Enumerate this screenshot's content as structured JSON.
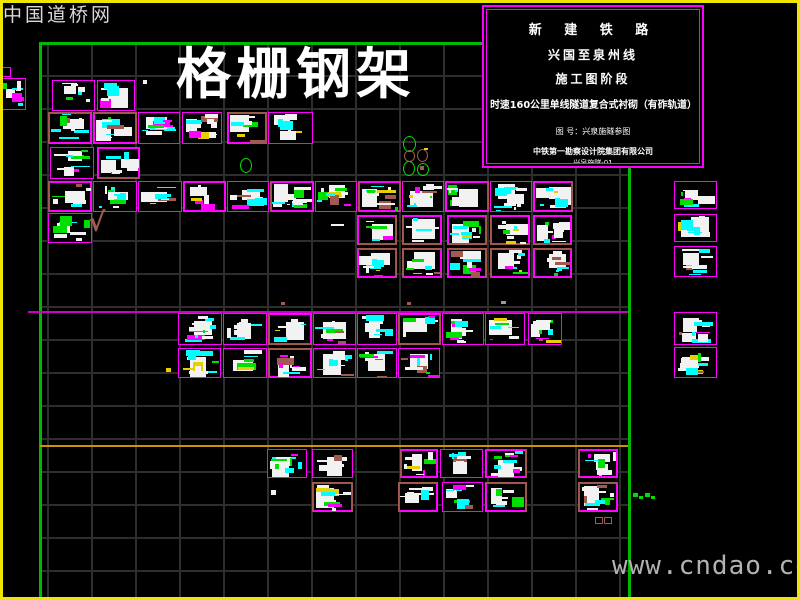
{
  "watermarks": {
    "top_left": "中国道桥网",
    "bottom_right": "www.cndao.com"
  },
  "sheet_title": "格栅钢架",
  "title_block": {
    "line1": "新 建 铁 路",
    "line2": "兴国至泉州线",
    "line3": "施工图阶段",
    "line4": "时速160公里单线隧道复合式衬砌（有砟轨道）",
    "line5": "图 号：兴泉施隧参图",
    "line6": "中铁第一勘察设计院集团有限公司",
    "line7": "兴泉施隧-01",
    "line8": "二〇一九年十月 制"
  },
  "colors": {
    "white": "#f2f2f2",
    "cyan": "#00ffff",
    "green": "#00e000",
    "magenta": "#ff00ff",
    "brown": "#a05a50",
    "yellow": "#e8d000",
    "red": "#ff2020",
    "gray": "#9a9a9a",
    "frame_green": "#00b800",
    "grid_gray": "#2e2e2e",
    "edge_yellow": "#efe600",
    "ref_magenta": "#cc00cc",
    "ref_yellow": "#c89600"
  },
  "drawing": {
    "frame": {
      "top_y": 42,
      "left_x": 39,
      "right_x": 628,
      "bottom_y": 598,
      "thickness": 3
    },
    "grid": {
      "x": 40,
      "y": 44,
      "w": 588,
      "h": 554,
      "cell_w": 44,
      "cell_h": 33,
      "off_x": 7,
      "off_y": 31
    },
    "ref_lines": [
      {
        "x": 28,
        "y": 311,
        "len": 600,
        "h": 2,
        "c": "ref_magenta"
      },
      {
        "x": 40,
        "y": 445,
        "len": 588,
        "h": 2,
        "c": "ref_yellow"
      }
    ],
    "cells": [
      [
        52,
        80,
        43,
        31,
        "m"
      ],
      [
        97,
        80,
        38,
        31,
        "m"
      ],
      [
        0,
        78,
        26,
        32,
        "m"
      ],
      [
        48,
        112,
        44,
        32,
        "b"
      ],
      [
        93,
        112,
        44,
        32,
        "b"
      ],
      [
        138,
        112,
        42,
        32,
        "m"
      ],
      [
        182,
        112,
        40,
        32,
        "m"
      ],
      [
        227,
        112,
        40,
        32,
        "b"
      ],
      [
        268,
        112,
        45,
        32,
        "m"
      ],
      [
        50,
        147,
        44,
        32,
        "m"
      ],
      [
        97,
        147,
        43,
        32,
        "b"
      ],
      [
        48,
        181,
        44,
        31,
        "b"
      ],
      [
        93,
        181,
        44,
        31,
        "m"
      ],
      [
        138,
        181,
        44,
        31,
        "m"
      ],
      [
        183,
        181,
        43,
        31,
        "b"
      ],
      [
        227,
        181,
        42,
        31,
        "m"
      ],
      [
        270,
        181,
        44,
        31,
        "b"
      ],
      [
        315,
        181,
        42,
        31,
        "m"
      ],
      [
        358,
        181,
        43,
        31,
        "b"
      ],
      [
        402,
        181,
        42,
        31,
        "m"
      ],
      [
        445,
        181,
        44,
        31,
        "b"
      ],
      [
        490,
        181,
        42,
        31,
        "m"
      ],
      [
        533,
        181,
        40,
        31,
        "b"
      ],
      [
        48,
        213,
        44,
        30,
        "m"
      ],
      [
        357,
        215,
        40,
        30,
        "b"
      ],
      [
        402,
        215,
        40,
        30,
        "b"
      ],
      [
        447,
        215,
        40,
        30,
        "b"
      ],
      [
        490,
        215,
        40,
        30,
        "b"
      ],
      [
        533,
        215,
        39,
        30,
        "b"
      ],
      [
        357,
        248,
        40,
        30,
        "b"
      ],
      [
        402,
        248,
        40,
        30,
        "b"
      ],
      [
        447,
        248,
        40,
        30,
        "b"
      ],
      [
        490,
        248,
        40,
        30,
        "b"
      ],
      [
        533,
        248,
        39,
        30,
        "b"
      ],
      [
        674,
        181,
        43,
        28,
        "m"
      ],
      [
        674,
        214,
        43,
        28,
        "m"
      ],
      [
        674,
        246,
        43,
        31,
        "m"
      ],
      [
        674,
        312,
        43,
        33,
        "m"
      ],
      [
        674,
        347,
        43,
        31,
        "m"
      ],
      [
        178,
        313,
        44,
        32,
        "m"
      ],
      [
        223,
        313,
        44,
        32,
        "m"
      ],
      [
        268,
        313,
        44,
        32,
        "b"
      ],
      [
        313,
        313,
        43,
        32,
        "m"
      ],
      [
        357,
        313,
        40,
        32,
        "m"
      ],
      [
        398,
        313,
        43,
        32,
        "b"
      ],
      [
        442,
        313,
        42,
        32,
        "m"
      ],
      [
        485,
        313,
        40,
        32,
        "m"
      ],
      [
        528,
        313,
        34,
        32,
        "m"
      ],
      [
        178,
        348,
        43,
        30,
        "m"
      ],
      [
        223,
        348,
        44,
        30,
        "m"
      ],
      [
        268,
        348,
        44,
        30,
        "b"
      ],
      [
        313,
        348,
        43,
        30,
        "m"
      ],
      [
        357,
        348,
        40,
        30,
        "m"
      ],
      [
        398,
        348,
        42,
        30,
        "m"
      ],
      [
        267,
        449,
        40,
        29,
        "m"
      ],
      [
        312,
        449,
        41,
        29,
        "m"
      ],
      [
        400,
        449,
        38,
        29,
        "b"
      ],
      [
        440,
        449,
        43,
        29,
        "m"
      ],
      [
        485,
        449,
        42,
        29,
        "b"
      ],
      [
        578,
        449,
        40,
        29,
        "b"
      ],
      [
        312,
        482,
        41,
        30,
        "b"
      ],
      [
        398,
        482,
        40,
        30,
        "b"
      ],
      [
        442,
        482,
        41,
        30,
        "m"
      ],
      [
        485,
        482,
        42,
        30,
        "b"
      ],
      [
        578,
        482,
        40,
        30,
        "b"
      ]
    ],
    "marks": [
      {
        "t": "text",
        "x": 88,
        "y": 210,
        "s": 26,
        "c": "brown",
        "v": "√"
      },
      {
        "t": "rect",
        "x": 0,
        "y": 67,
        "w": 9,
        "h": 8,
        "c": "magenta",
        "f": false
      },
      {
        "t": "rect",
        "x": 143,
        "y": 80,
        "w": 4,
        "h": 4,
        "c": "white",
        "f": true
      },
      {
        "t": "ellipse",
        "x": 240,
        "y": 158,
        "w": 10,
        "h": 13,
        "c": "green",
        "f": false
      },
      {
        "t": "ellipse",
        "x": 403,
        "y": 136,
        "w": 11,
        "h": 14,
        "c": "green",
        "f": false
      },
      {
        "t": "ellipse",
        "x": 404,
        "y": 150,
        "w": 9,
        "h": 10,
        "c": "brown",
        "f": false
      },
      {
        "t": "ellipse",
        "x": 403,
        "y": 161,
        "w": 10,
        "h": 13,
        "c": "green",
        "f": false
      },
      {
        "t": "ellipse",
        "x": 417,
        "y": 149,
        "w": 9,
        "h": 11,
        "c": "brown",
        "f": false
      },
      {
        "t": "rect",
        "x": 424,
        "y": 148,
        "w": 4,
        "h": 2,
        "c": "yellow",
        "f": true
      },
      {
        "t": "ellipse",
        "x": 417,
        "y": 163,
        "w": 10,
        "h": 11,
        "c": "green",
        "f": false
      },
      {
        "t": "rect",
        "x": 420,
        "y": 166,
        "w": 4,
        "h": 4,
        "c": "brown",
        "f": true
      },
      {
        "t": "rect",
        "x": 331,
        "y": 224,
        "w": 13,
        "h": 2,
        "c": "white",
        "f": true
      },
      {
        "t": "rect",
        "x": 166,
        "y": 368,
        "w": 5,
        "h": 4,
        "c": "yellow",
        "f": true
      },
      {
        "t": "rect",
        "x": 281,
        "y": 302,
        "w": 4,
        "h": 3,
        "c": "brown",
        "f": true
      },
      {
        "t": "rect",
        "x": 407,
        "y": 302,
        "w": 4,
        "h": 3,
        "c": "brown",
        "f": true
      },
      {
        "t": "rect",
        "x": 501,
        "y": 301,
        "w": 5,
        "h": 3,
        "c": "gray",
        "f": true
      },
      {
        "t": "rect",
        "x": 271,
        "y": 490,
        "w": 5,
        "h": 5,
        "c": "white",
        "f": true
      },
      {
        "t": "rect",
        "x": 633,
        "y": 493,
        "w": 5,
        "h": 4,
        "c": "green",
        "f": true
      },
      {
        "t": "rect",
        "x": 639,
        "y": 496,
        "w": 4,
        "h": 3,
        "c": "green",
        "f": true
      },
      {
        "t": "rect",
        "x": 645,
        "y": 493,
        "w": 5,
        "h": 4,
        "c": "green",
        "f": true
      },
      {
        "t": "rect",
        "x": 651,
        "y": 496,
        "w": 4,
        "h": 3,
        "c": "green",
        "f": true
      },
      {
        "t": "rect",
        "x": 595,
        "y": 517,
        "w": 6,
        "h": 5,
        "c": "brown",
        "f": false
      },
      {
        "t": "rect",
        "x": 604,
        "y": 517,
        "w": 6,
        "h": 5,
        "c": "brown",
        "f": false
      }
    ]
  }
}
